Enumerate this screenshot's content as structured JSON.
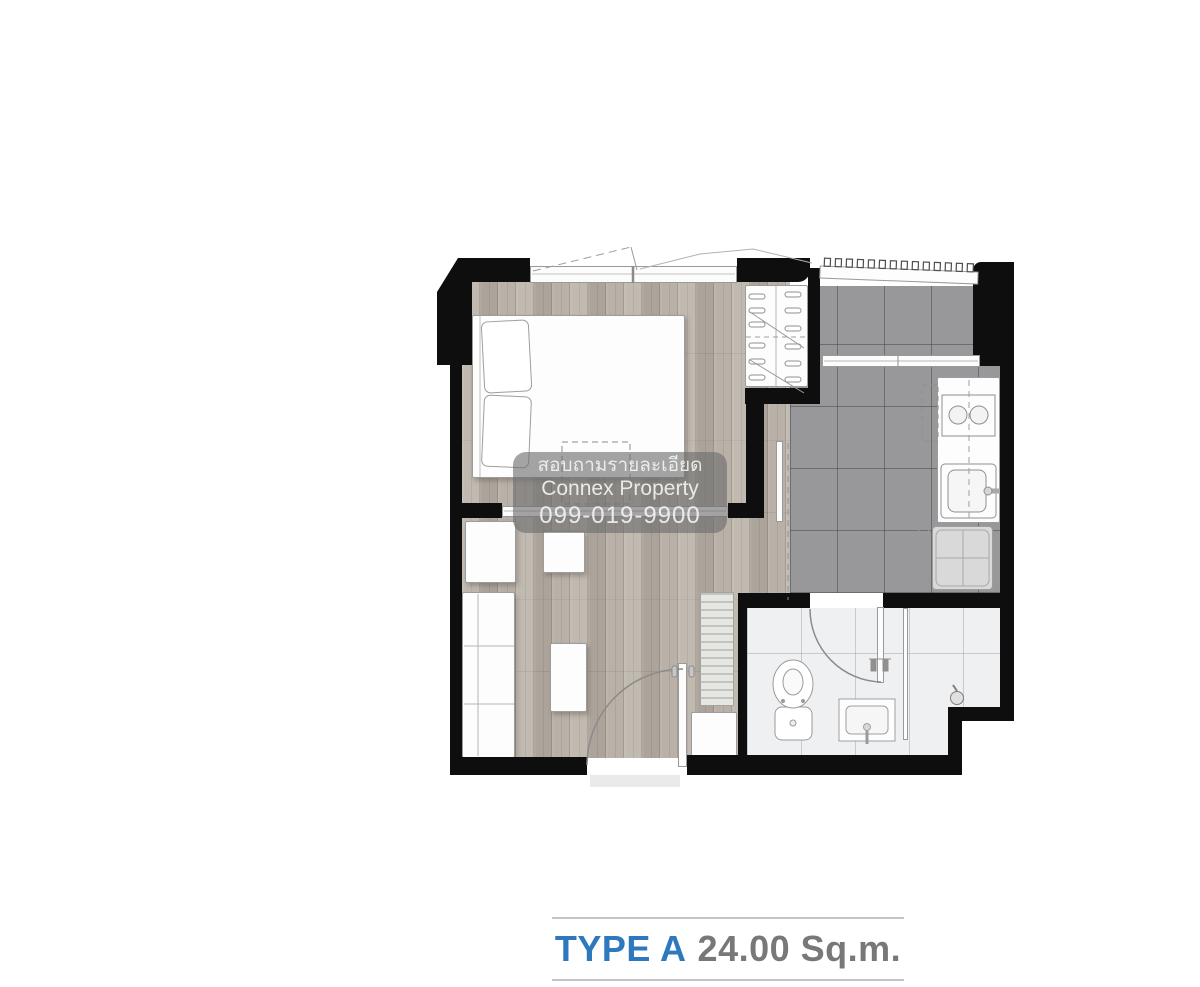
{
  "image_type": "condominium-unit-floor-plan",
  "caption": {
    "type_label": "TYPE A",
    "area_label": "24.00 Sq.m."
  },
  "watermark": {
    "line1": "สอบถามรายละเอียด",
    "line2": "Connex Property",
    "line3": "099-019-9900"
  },
  "colors": {
    "caption_blue": "#2e78bd",
    "caption_gray": "#787878",
    "wall_black": "#0e0e0e",
    "kitchen_tile_gray": "#98989b",
    "wood_floor_beige": "#b6aea4",
    "bathroom_floor": "#eff0f2",
    "watermark_background": "rgba(108,108,108,0.62)"
  },
  "fixtures": [
    "double-bed",
    "pillows",
    "wardrobe-hangers",
    "sliding-partition",
    "sofa",
    "table",
    "entrance-door",
    "balcony-railing",
    "kitchen-counter",
    "two-burner-stove",
    "kitchen-sink",
    "washing-machine",
    "bathroom-door",
    "toilet",
    "vanity-sink",
    "shower-partition",
    "shower-head"
  ]
}
